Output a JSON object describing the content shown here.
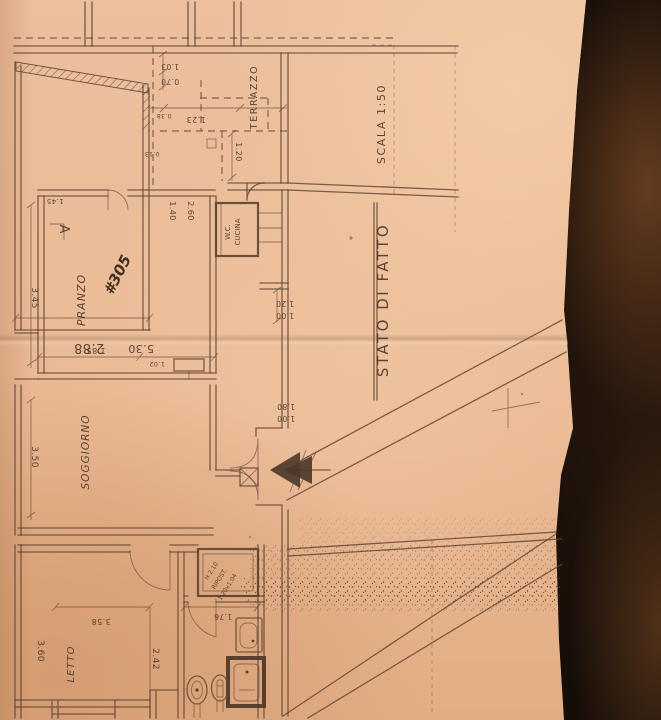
{
  "photo": {
    "backdrop": "#150d08",
    "paper": "#ecbf9d",
    "ink": "#5c4433",
    "pen": "#342318"
  },
  "titles": {
    "status": "STATO DI FATTO",
    "scale": "SCALA 1:50"
  },
  "rooms": {
    "terrazzo": "TERRAZZO",
    "pranzo": "PRANZO",
    "soggiorno": "SOGGIORNO",
    "letto": "LETTO",
    "wc": "W.C.",
    "cucina": "CUCINA",
    "ripost_h": "H 2.10",
    "ripost": "RIPOST.",
    "ripost_size": "1.20x1.04",
    "unit": "#305",
    "section_a": "A"
  },
  "dims": {
    "d288": "2.88",
    "d103": "1.03",
    "d070": "0.70",
    "d123": "1.23",
    "d120_terrace": "1.20",
    "d140": "1.40",
    "d260": "2.60",
    "d120_hall": "1.20",
    "d100_hall": "1.00",
    "d345": "3.45",
    "d145": "1.45",
    "d185": "1.85",
    "d530": "5.30",
    "d102": "1.02",
    "d350": "3.50",
    "d180": "1.80",
    "d100_entry": "1.00",
    "d360": "3.60",
    "d358": "3.58",
    "d242": "2.42",
    "d176": "1.76",
    "d038": "0.38",
    "d013": "0.13"
  }
}
